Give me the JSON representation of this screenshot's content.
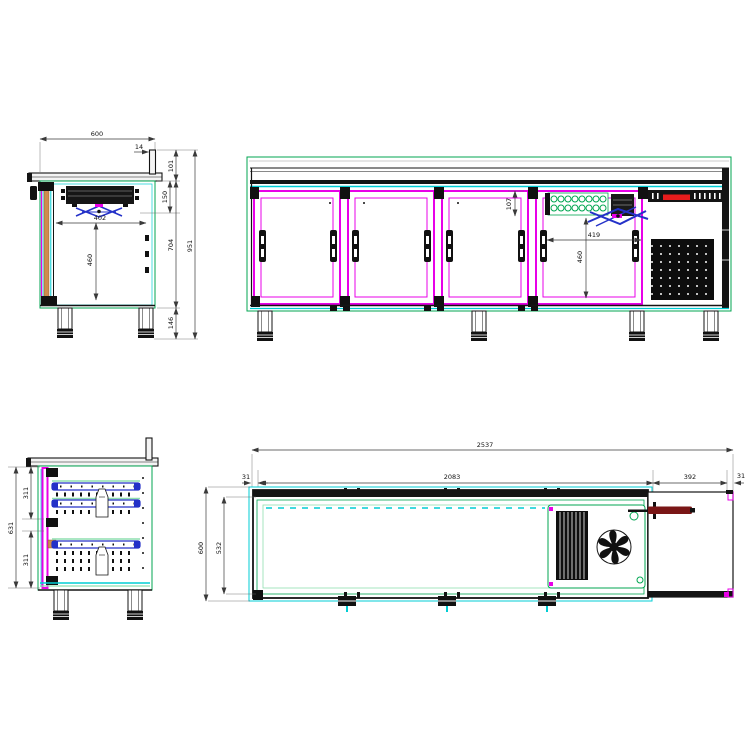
{
  "drawing": {
    "type": "technical-cad-drawing",
    "subject": "four-door refrigerated counter with drawers and condensing unit",
    "colors": {
      "outline_green": "#00a651",
      "light_green": "#8fdfb0",
      "cyan": "#00cdd4",
      "magenta": "#e800e8",
      "blue": "#2431c8",
      "gasket_orange": "#cf8a4e",
      "handle_dark_red": "#7a1616",
      "logo_red": "#e81c1c",
      "ink": "#141414"
    },
    "views": {
      "side_section_top": {
        "label": "side section view",
        "dims": {
          "depth": "600",
          "upstand_lip": "14",
          "top_section_height": "101",
          "evaporator_drop": "150",
          "interior_depth": "402",
          "interior_height": "460",
          "body_height": "704",
          "overall_height": "951",
          "leg_height": "146"
        }
      },
      "front": {
        "label": "front view",
        "dims": {
          "top_offset": "107",
          "bay_width": "419",
          "door_opening_height": "460"
        }
      },
      "side_section_drawers": {
        "label": "side section view with drawers",
        "dims": {
          "overall_interior": "631",
          "upper_drawer": "311",
          "lower_drawer": "311"
        }
      },
      "plan": {
        "label": "top plan view",
        "dims": {
          "overall_width": "2537",
          "wall_left": "31",
          "interior_width": "2083",
          "machine_bay_width": "392",
          "wall_right": "31",
          "depth": "600",
          "interior_depth": "532"
        }
      }
    }
  }
}
